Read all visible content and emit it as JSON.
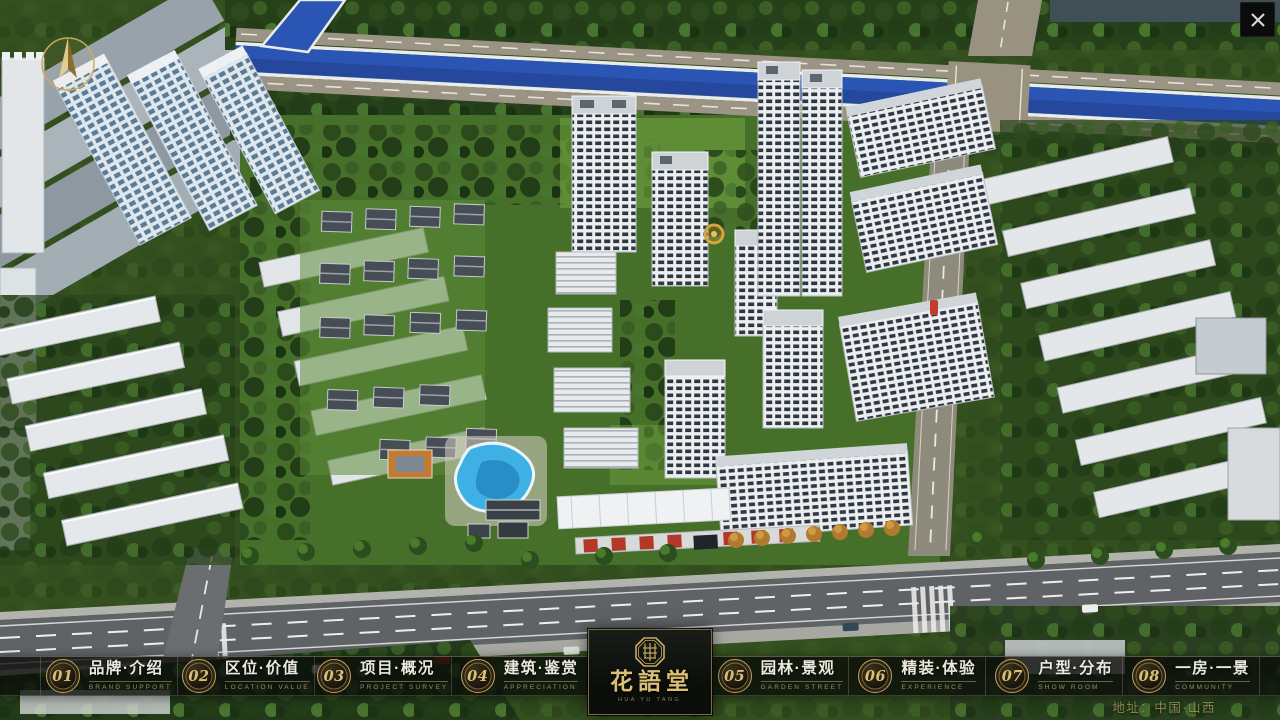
{
  "window": {
    "close_label": "✕",
    "address": "地址：中国·山西"
  },
  "navbar": {
    "items": [
      {
        "num": "01",
        "title": "品牌·介绍",
        "subtitle": "BRAND SUPPORT"
      },
      {
        "num": "02",
        "title": "区位·价值",
        "subtitle": "LOCATION VALUE"
      },
      {
        "num": "03",
        "title": "项目·概况",
        "subtitle": "PROJECT SURVEY"
      },
      {
        "num": "04",
        "title": "建筑·鉴赏",
        "subtitle": "APPRECIATION"
      },
      {
        "num": "05",
        "title": "园林·景观",
        "subtitle": "GARDEN STREET"
      },
      {
        "num": "06",
        "title": "精装·体验",
        "subtitle": "EXPERIENCE"
      },
      {
        "num": "07",
        "title": "户型·分布",
        "subtitle": "SHOW ROOM"
      },
      {
        "num": "08",
        "title": "一房·一景",
        "subtitle": "COMMUNITY"
      }
    ],
    "logo": {
      "title": "花語堂",
      "subtitle": "HUA YU TANG"
    }
  },
  "icons": {
    "compass": "compass-north-icon",
    "close": "close-icon",
    "seal": "brand-seal-icon"
  },
  "palette": {
    "gold": "#c2a15c",
    "gold-bright": "#dcbe74",
    "bar-bg": "rgba(9,11,9,0.78)",
    "text-white": "#eae8df",
    "text-en": "#9a8f63",
    "river": "#2b55b5",
    "grass": "#4e7a2e"
  }
}
